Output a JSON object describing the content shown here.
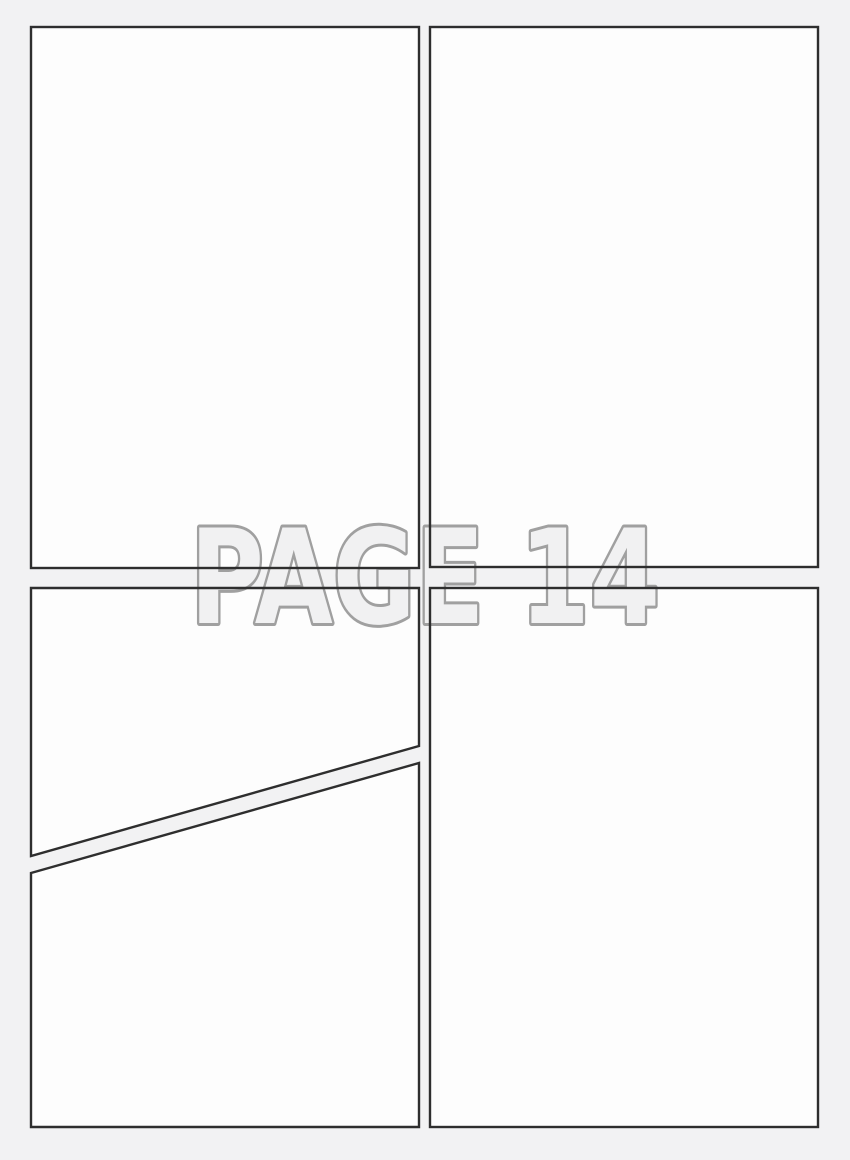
{
  "page": {
    "watermark_label": "PAGE 14"
  },
  "colors": {
    "background": "#f2f2f3",
    "panel_fill": "#fdfdfd",
    "panel_border": "#2e2e2e",
    "watermark_fill": "#f1f1f2",
    "watermark_outline": "#a0a0a0"
  }
}
